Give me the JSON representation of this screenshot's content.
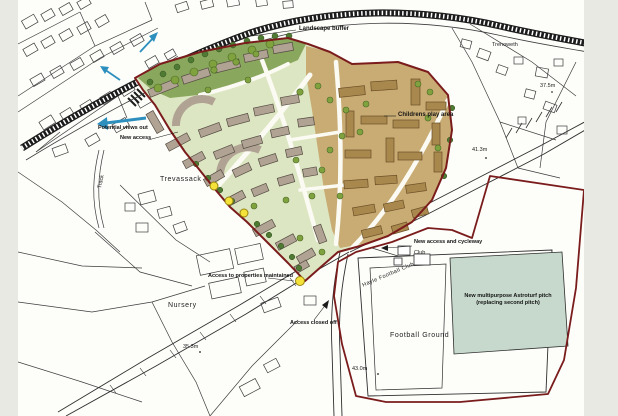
{
  "canvas": {
    "background_color": "#e9e9e4",
    "paper_color": "#fdfdfa"
  },
  "colors": {
    "site_boundary_red": "#7a1c1c",
    "landscape_buffer_green": "#8aa75e",
    "housing_area_green": "#dde6c2",
    "housing_area_tan": "#c9ac74",
    "building_gray": "#b0a394",
    "building_brown": "#a9884e",
    "tree_green": "#7fa23f",
    "tree_dark_green": "#4e7a33",
    "astroturf_pitch_green": "#c6d9cc",
    "arrow_blue": "#2d8fbd",
    "access_marker_yellow": "#f4e23a",
    "linework_black": "#2f2f2f"
  },
  "labels": {
    "landscape_buffer": "Landscape buffer",
    "trenoweth": "Trenoweth",
    "spot_height_375": "37.5m",
    "childrens_play_area": "Childrens play area",
    "spot_height_413": "41.3m",
    "potential_views_out": "Potential views out",
    "new_access": "New access",
    "trevassack": "Trevassack",
    "track": "Track",
    "access_to_properties": "Access to properties maintained",
    "nursery": "Nursery",
    "spot_height_353": "35.3m",
    "access_closed_off": "Access closed off",
    "new_access_and_cycleway": "New access and cycleway",
    "club": "Club",
    "hayle_football_club": "Hayle Football Club",
    "astroturf_pitch_line1": "New multipurpose Astroturf pitch",
    "astroturf_pitch_line2": "(replacing second pitch)",
    "football_ground": "Football Ground",
    "spot_height_430": "43.0m"
  }
}
